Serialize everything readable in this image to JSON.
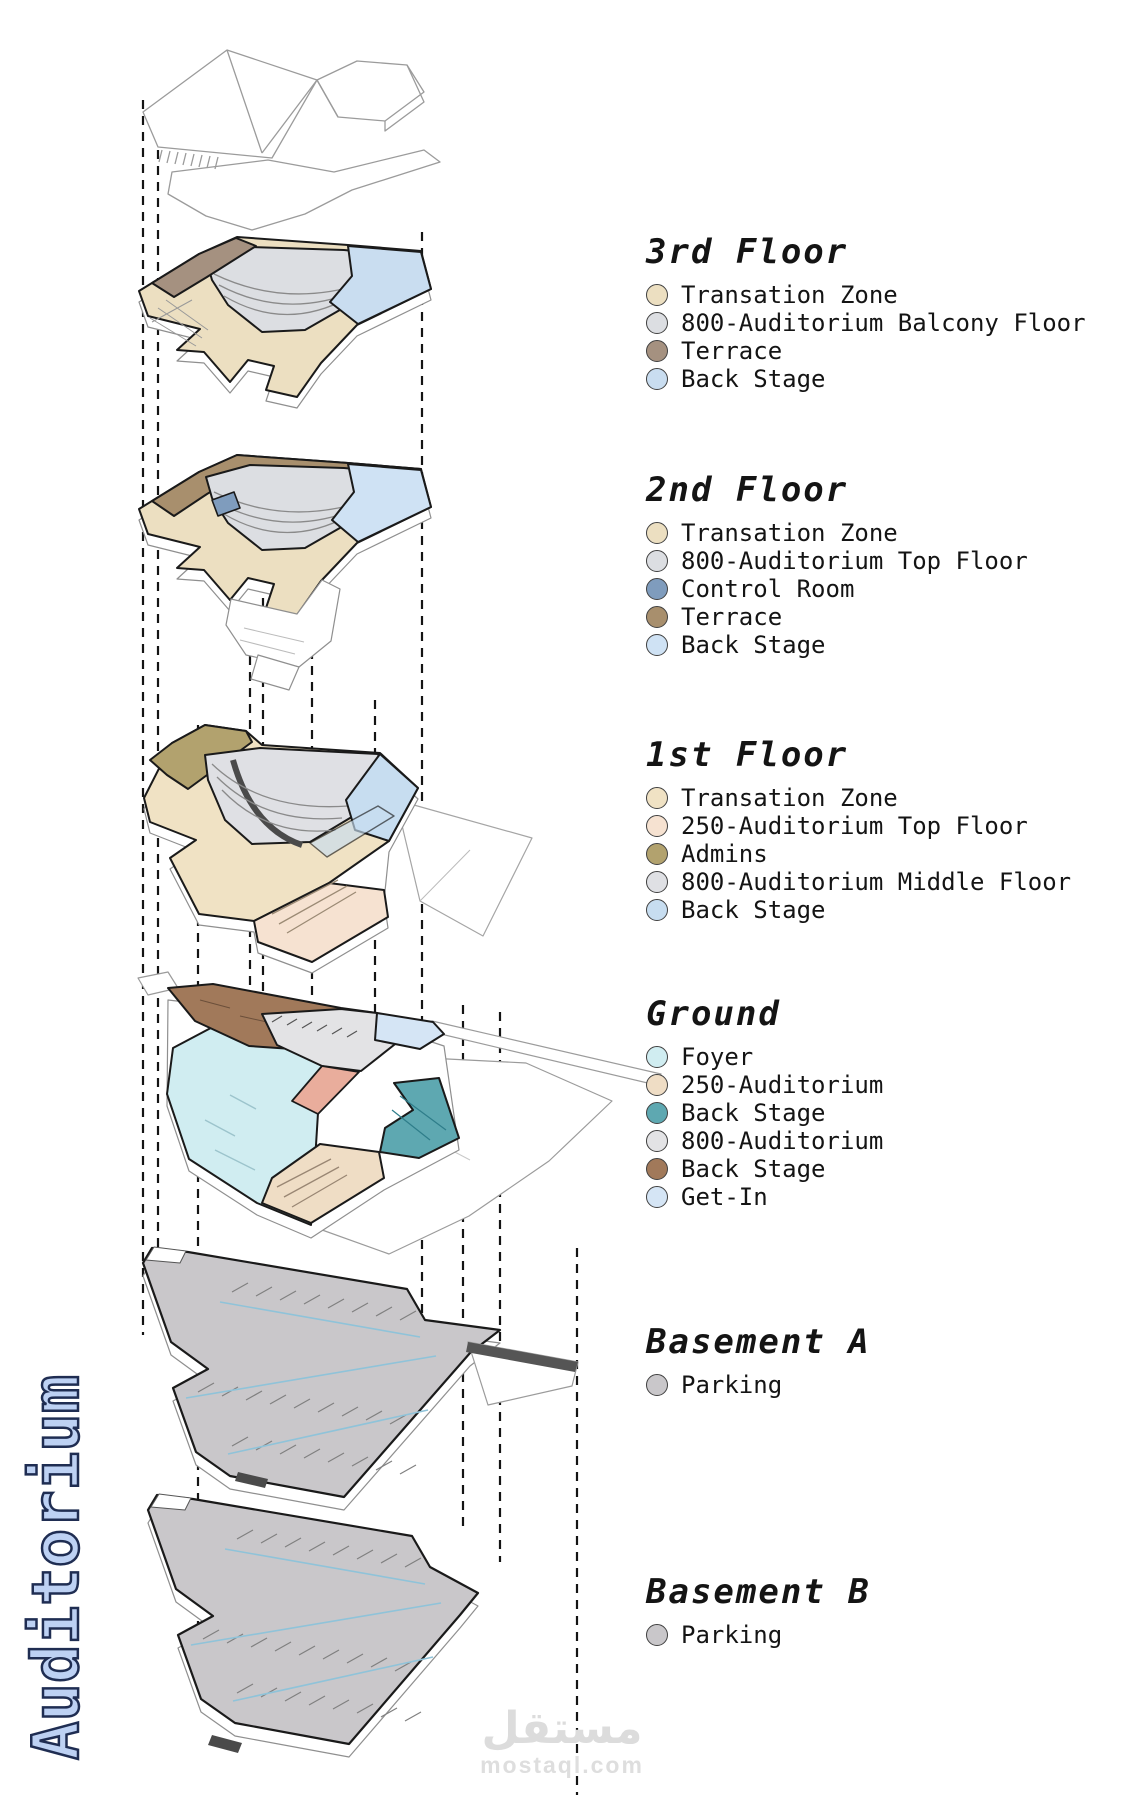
{
  "side_label": {
    "text": "Auditorium",
    "fill_color": "#bdd1f3",
    "outline_color": "#1f2d52"
  },
  "watermark": {
    "arabic": "مستقل",
    "domain": "mostaql.com",
    "color": "#dcdcdc"
  },
  "diagram": {
    "dashed_line_color": "#141414",
    "outline_color": "#1a1a1a",
    "wireframe_color": "#9b9b9b",
    "corridor_color": "#e9ad9c",
    "aisle_color": "#8fc3d9",
    "seat_line_color": "#8a8a8a",
    "dark_detail_color": "#4a4a4a"
  },
  "floors": [
    {
      "id": "floor-3",
      "title": "3rd Floor",
      "items": [
        {
          "label": "Transation Zone",
          "color": "#ecdfc1"
        },
        {
          "label": "800-Auditorium Balcony Floor",
          "color": "#dcdee2"
        },
        {
          "label": "Terrace",
          "color": "#a59180"
        },
        {
          "label": "Back Stage",
          "color": "#c9ddf0"
        }
      ]
    },
    {
      "id": "floor-2",
      "title": "2nd Floor",
      "items": [
        {
          "label": "Transation Zone",
          "color": "#ecdfc1"
        },
        {
          "label": "800-Auditorium Top Floor",
          "color": "#dcdee2"
        },
        {
          "label": "Control Room",
          "color": "#7f9cbd"
        },
        {
          "label": "Terrace",
          "color": "#a88f6d"
        },
        {
          "label": "Back Stage",
          "color": "#cfe2f4"
        }
      ]
    },
    {
      "id": "floor-1",
      "title": "1st Floor",
      "items": [
        {
          "label": "Transation Zone",
          "color": "#f0e2c4"
        },
        {
          "label": "250-Auditorium Top Floor",
          "color": "#f6e2d1"
        },
        {
          "label": "Admins",
          "color": "#b2a26e"
        },
        {
          "label": "800-Auditorium Middle Floor",
          "color": "#dfe0e4"
        },
        {
          "label": "Back Stage",
          "color": "#c7ddf0"
        }
      ]
    },
    {
      "id": "ground",
      "title": "Ground",
      "items": [
        {
          "label": "Foyer",
          "color": "#d0edf1"
        },
        {
          "label": "250-Auditorium",
          "color": "#efddc5"
        },
        {
          "label": "Back Stage",
          "color": "#5ea8b1"
        },
        {
          "label": "800-Auditorium",
          "color": "#e3e3e5"
        },
        {
          "label": "Back Stage",
          "color": "#a1795a"
        },
        {
          "label": "Get-In",
          "color": "#d5e5f5"
        }
      ]
    },
    {
      "id": "basement-a",
      "title": "Basement A",
      "items": [
        {
          "label": "Parking",
          "color": "#c9c7ca"
        }
      ]
    },
    {
      "id": "basement-b",
      "title": "Basement B",
      "items": [
        {
          "label": "Parking",
          "color": "#c9c7ca"
        }
      ]
    }
  ]
}
